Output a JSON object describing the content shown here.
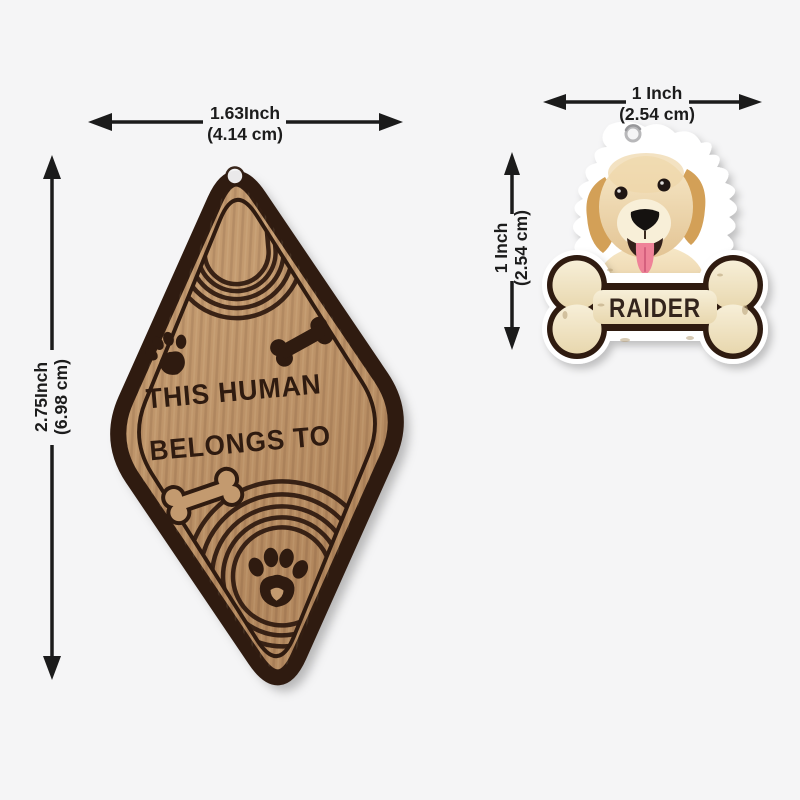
{
  "colors": {
    "background": "#f5f5f6",
    "dimension_text": "#1c1c1c",
    "arrow": "#1b1b1b",
    "wood": "#b78c63",
    "engraving": "#2f1b10",
    "acrylic_edge": "#ffffff",
    "bone_cream": "#f2e7c9",
    "bone_outline": "#2f1b10",
    "pet_name_text": "#33241c"
  },
  "keychain": {
    "engraving": {
      "line1": "THIS HUMAN",
      "line2": "BELONGS TO"
    },
    "width_dimension": {
      "inch": "1.63Inch",
      "cm": "(4.14 cm)"
    },
    "height_dimension": {
      "inch": "2.75Inch",
      "cm": "(6.98 cm)"
    },
    "decorations": [
      "rainbow-arcs-top",
      "paw-icon",
      "bone-filled-icon",
      "bone-outline-icon",
      "paw-icon-large",
      "hang-hole"
    ]
  },
  "charm": {
    "pet_name": "RAIDER",
    "width_dimension": {
      "inch": "1 Inch",
      "cm": "(2.54 cm)"
    },
    "height_dimension": {
      "inch": "1 Inch",
      "cm": "(2.54 cm)"
    },
    "decorations": [
      "dog-photo",
      "bone-name-tag",
      "hang-hole"
    ]
  }
}
